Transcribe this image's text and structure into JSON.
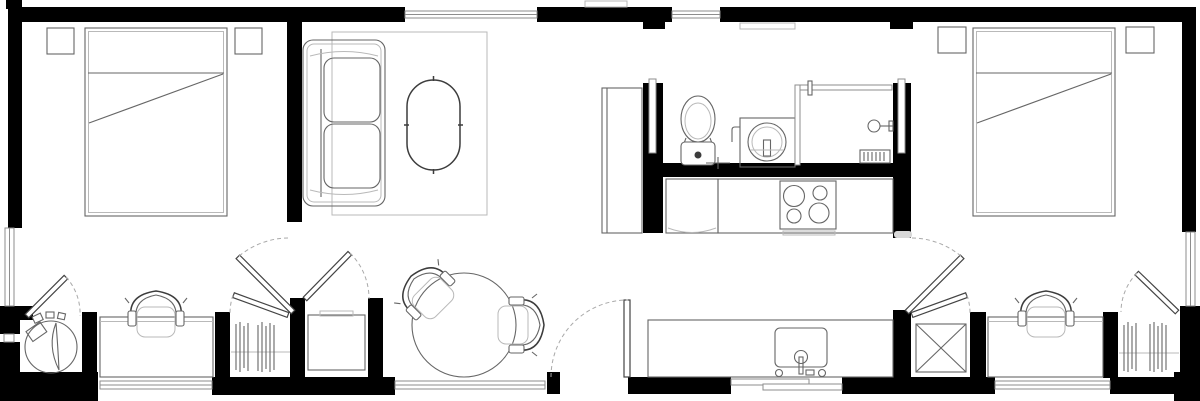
{
  "meta": {
    "type": "architectural floor plan",
    "description": "black-and-white top-view floor plan of a long rectangular dwelling with two bedrooms, living room, dining area, bathroom and galley kitchen",
    "canvas": {
      "width": 1200,
      "height": 401
    }
  },
  "colors": {
    "background": "#ffffff",
    "wall": "#000000",
    "furniture": "#666666",
    "furniture_dark": "#3c3c3c",
    "light": "#b9b9b9",
    "glazing": "#8d8d8d",
    "door_leaf": "#444444",
    "swing_arc": "#a9a9a9"
  },
  "rooms": [
    {
      "id": "bedroom-left",
      "fixtures": [
        "double-bed",
        "nightstand",
        "nightstand",
        "side-window"
      ]
    },
    {
      "id": "living-room",
      "fixtures": [
        "sofa",
        "coffee-table",
        "area-rug",
        "top-window"
      ]
    },
    {
      "id": "hall-left",
      "fixtures": [
        "round-appliance",
        "desk",
        "desk-chair",
        "wardrobe-closet",
        "bottom-window"
      ]
    },
    {
      "id": "entry-dining",
      "fixtures": [
        "round-dining-table",
        "dining-chair",
        "dining-chair",
        "appliance-cabinet",
        "entry-door",
        "bottom-window"
      ]
    },
    {
      "id": "bathroom",
      "fixtures": [
        "toilet",
        "washing-machine",
        "shower-enclosure",
        "shower-head",
        "floor-drain",
        "pocket-door",
        "pocket-door"
      ]
    },
    {
      "id": "kitchen",
      "fixtures": [
        "tall-cabinet",
        "under-counter-unit",
        "cooktop-4-burners",
        "upper-counter",
        "island-counter",
        "sink-with-faucet"
      ]
    },
    {
      "id": "hall-right",
      "fixtures": [
        "mechanical-closet-x",
        "desk",
        "desk-chair",
        "wardrobe-closet",
        "bottom-window"
      ]
    },
    {
      "id": "bedroom-right",
      "fixtures": [
        "double-bed",
        "nightstand",
        "nightstand",
        "side-window"
      ]
    }
  ],
  "openings": {
    "windows_top": 2,
    "windows_bottom": 4,
    "windows_left": 1,
    "windows_right": 1,
    "hinged_doors": 8,
    "sliding_doors": 2
  }
}
